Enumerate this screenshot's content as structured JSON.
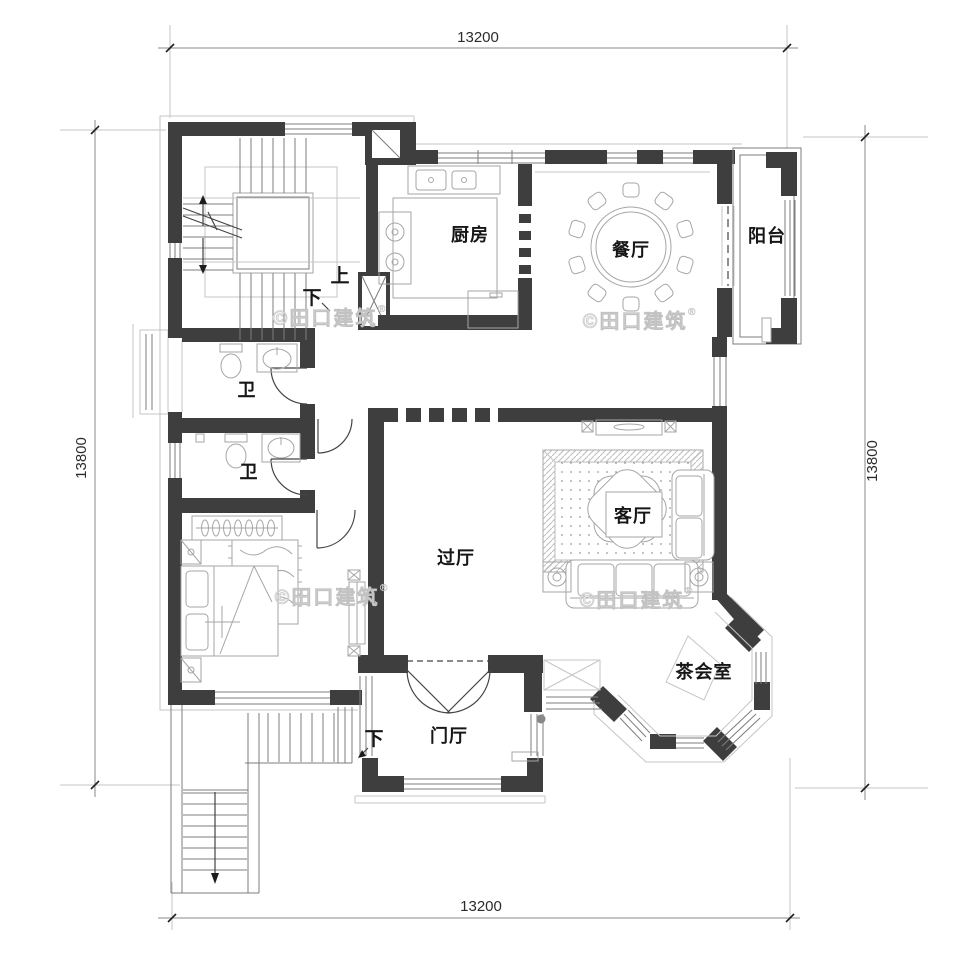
{
  "plan": {
    "dimensions": {
      "top": "13200",
      "bottom": "13200",
      "left": "13800",
      "right": "13800"
    },
    "rooms": {
      "kitchen": "厨房",
      "dining": "餐厅",
      "balcony": "阳台",
      "bath1": "卫",
      "bath2": "卫",
      "hall": "过厅",
      "living": "客厅",
      "tea_room": "茶会室",
      "foyer": "门厅"
    },
    "stairs": {
      "up": "上",
      "down": "下",
      "down_exterior": "下"
    },
    "watermark": {
      "text": "©田口建筑",
      "registered": "®"
    },
    "colors": {
      "wall": "#3e3e3e",
      "window_line": "#7d7d7d",
      "furniture_line": "#a6a6a6",
      "light_line": "#c6c6c6",
      "label": "#161616",
      "dimension": "#2b2b2b",
      "watermark": "#ececec",
      "background": "#ffffff"
    }
  }
}
